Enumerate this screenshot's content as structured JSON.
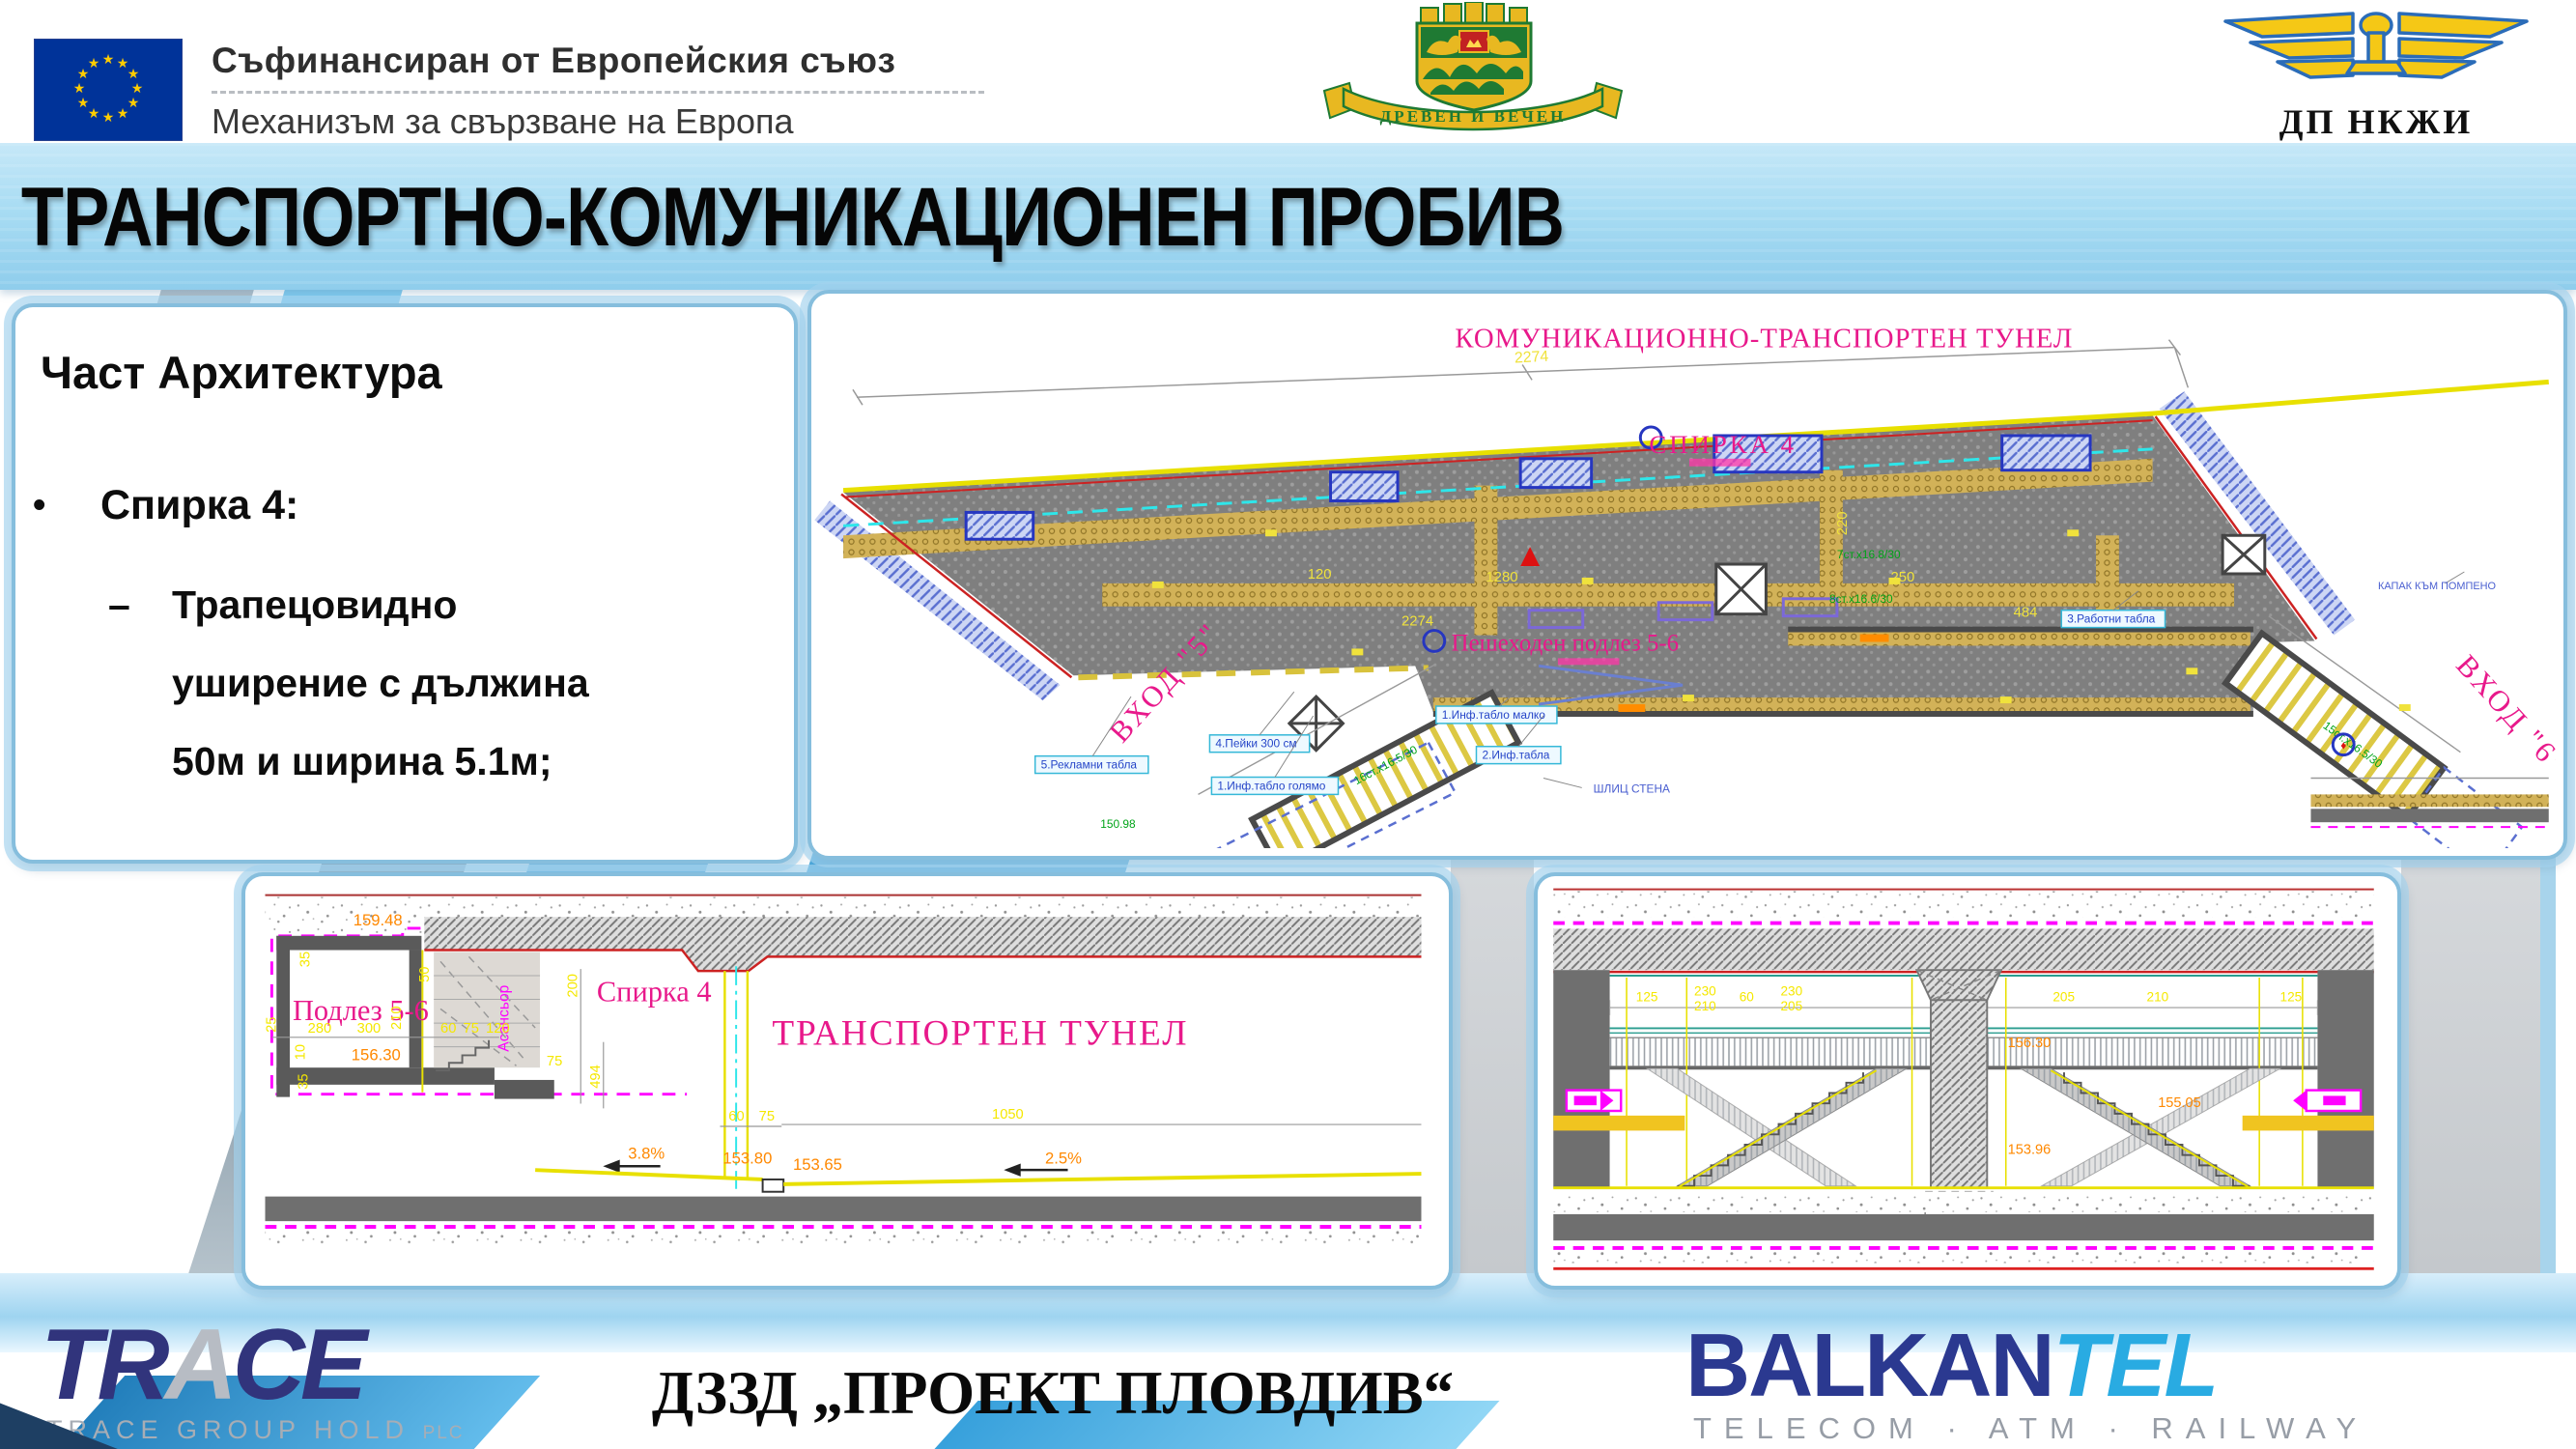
{
  "header": {
    "eu_line1": "Съфинансиран от Европейския съюз",
    "eu_line2": "Механизъм за свързване на Европа",
    "plovdiv_motto": "ДРЕВЕН И ВЕЧЕН",
    "railway_label": "ДП НКЖИ"
  },
  "title": "ТРАНСПОРТНО-КОМУНИКАЦИОНЕН ПРОБИВ",
  "left_panel": {
    "heading": "Част Архитектура",
    "bullet_marker": "•",
    "bullet": "Спирка 4:",
    "dash_marker": "–",
    "sub_line1": "Трапецовидно",
    "sub_line2": "уширение с дължина",
    "sub_line3": "50м и ширина 5.1м;"
  },
  "plan": {
    "title": "КОМУНИКАЦИОННО-ТРАНСПОРТЕН ТУНЕЛ",
    "stop_label": "СПИРКА 4",
    "underpass_label": "Пешеходен подлез 5-6",
    "entrance5": "ВХОД \"5\"",
    "entrance6": "ВХОД \"6\"",
    "small_labels": [
      "5.Рекламни табла",
      "4.Пейки 300 см",
      "1.Инф.табло голямо",
      "2.Инф.табла",
      "1.Инф.табло малко",
      "3.Работни табла",
      "ШЛИЦ СТЕНА",
      "КАПАК КЪМ ПОМПЕНО"
    ],
    "green_notes": [
      "7ст.х16.8/30",
      "8ст.х16.6/30",
      "16ст.х16.5/30",
      "15ст.х16.5/30"
    ],
    "green_elev": "150.98",
    "dims": [
      "2274",
      "1280",
      "250",
      "220",
      "120",
      "484"
    ]
  },
  "section": {
    "underpass_label": "Подлез 5-6",
    "stop_label": "Спирка 4",
    "tunnel_label": "ТРАНСПОРТЕН ТУНЕЛ",
    "elevator_label": "Асансьор",
    "elevations": [
      "159.48",
      "156.30",
      "153.80",
      "153.65"
    ],
    "slopes": [
      "3.8%",
      "2.5%"
    ],
    "dims": [
      "35",
      "50",
      "25",
      "280",
      "300",
      "210",
      "60",
      "75",
      "120",
      "10",
      "35",
      "200",
      "75",
      "494",
      "60",
      "75",
      "1050"
    ]
  },
  "cross_section": {
    "elevations": [
      "156.30",
      "155.05",
      "153.96"
    ],
    "dims": [
      "125",
      "230",
      "210",
      "60",
      "230",
      "205",
      "220",
      "205",
      "210",
      "125"
    ]
  },
  "footer": {
    "trace_main_1": "TR",
    "trace_main_2": "A",
    "trace_main_3": "CE",
    "trace_sub": "TRACE GROUP HOLD",
    "trace_sub_small": "PLC",
    "consortium": "ДЗЗД  „ПРОЕКТ ПЛОВДИВ“",
    "balkantel_1": "BALKAN",
    "balkantel_2": "TEL",
    "balkantel_sub": "TELECOM · ATM · RAILWAY"
  }
}
